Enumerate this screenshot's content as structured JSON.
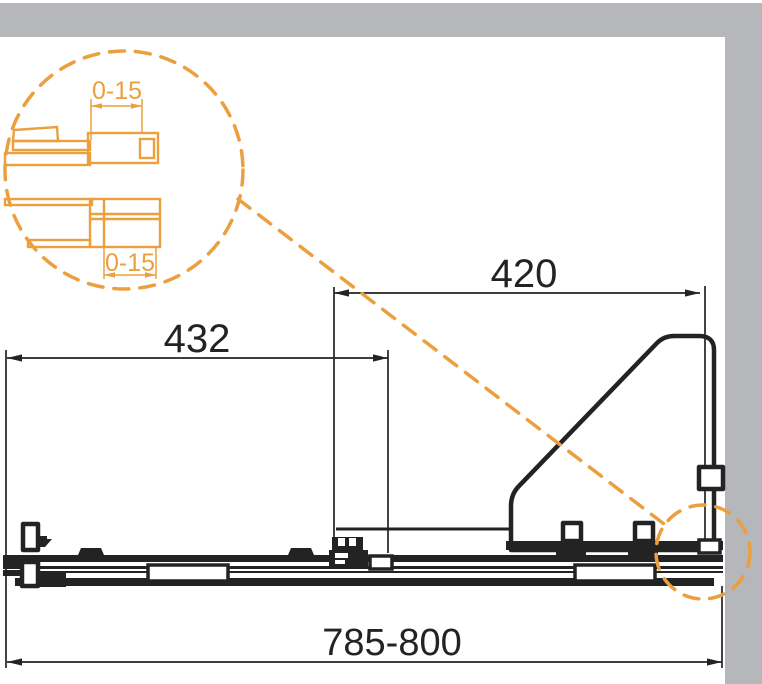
{
  "colors": {
    "accent_orange": "#EB9F3E",
    "ink_black": "#232323",
    "wall_gray": "#B5B7BB",
    "background": "#FFFFFF"
  },
  "drawing": {
    "type": "technical-installation-diagram",
    "subject": "sliding bath screen profile, plan view with wall section",
    "dimensions": {
      "total_width_label": "785-800",
      "sliding_panel_label": "432",
      "fixed_panel_label": "420",
      "detail_top_adjustment_label": "0-15",
      "detail_bottom_adjustment_label": "0-15"
    }
  }
}
